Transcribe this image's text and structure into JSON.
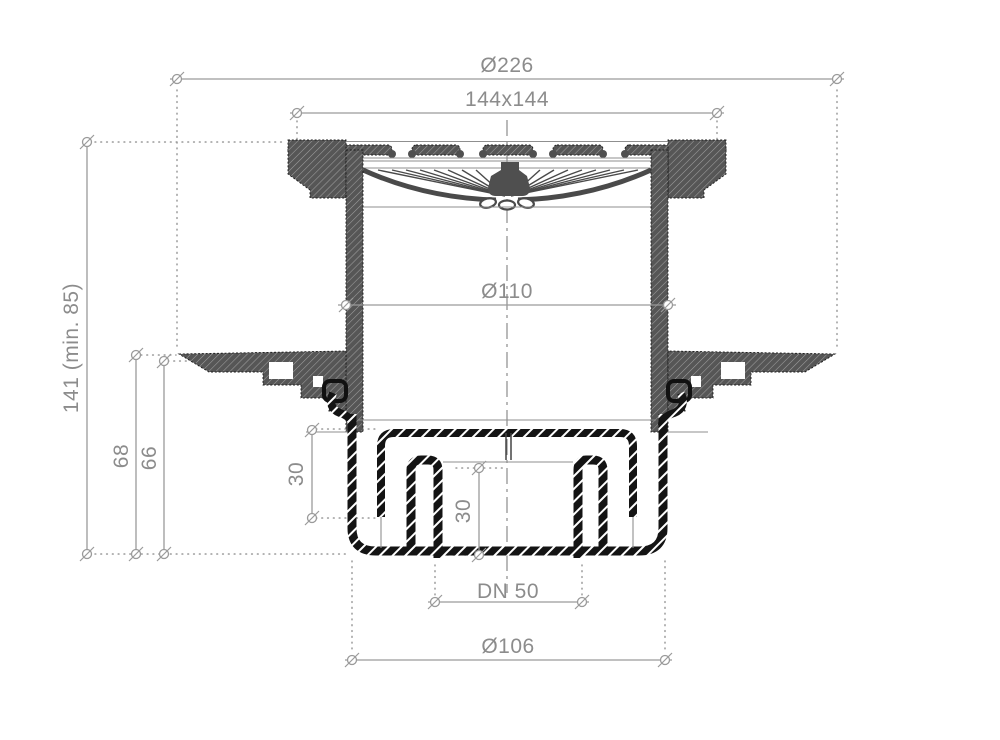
{
  "drawing": {
    "type": "technical-cross-section",
    "subject": "floor-drain-with-trap"
  },
  "dimensions": {
    "overall_flange": "Ø226",
    "grate_size": "144x144",
    "body_diameter": "Ø110",
    "total_height": "141 (min. 85)",
    "flange_height_outer": "68",
    "flange_height_inner": "66",
    "trap_depth_left": "30",
    "trap_depth_center": "30",
    "outlet_size": "DN 50",
    "base_diameter": "Ø106"
  },
  "colors": {
    "dimension_line": "#9a9a9a",
    "dimension_text": "#8c8c8c",
    "section_fill": "#4f4f4f",
    "outline": "#1a1a1a",
    "background": "#ffffff"
  }
}
